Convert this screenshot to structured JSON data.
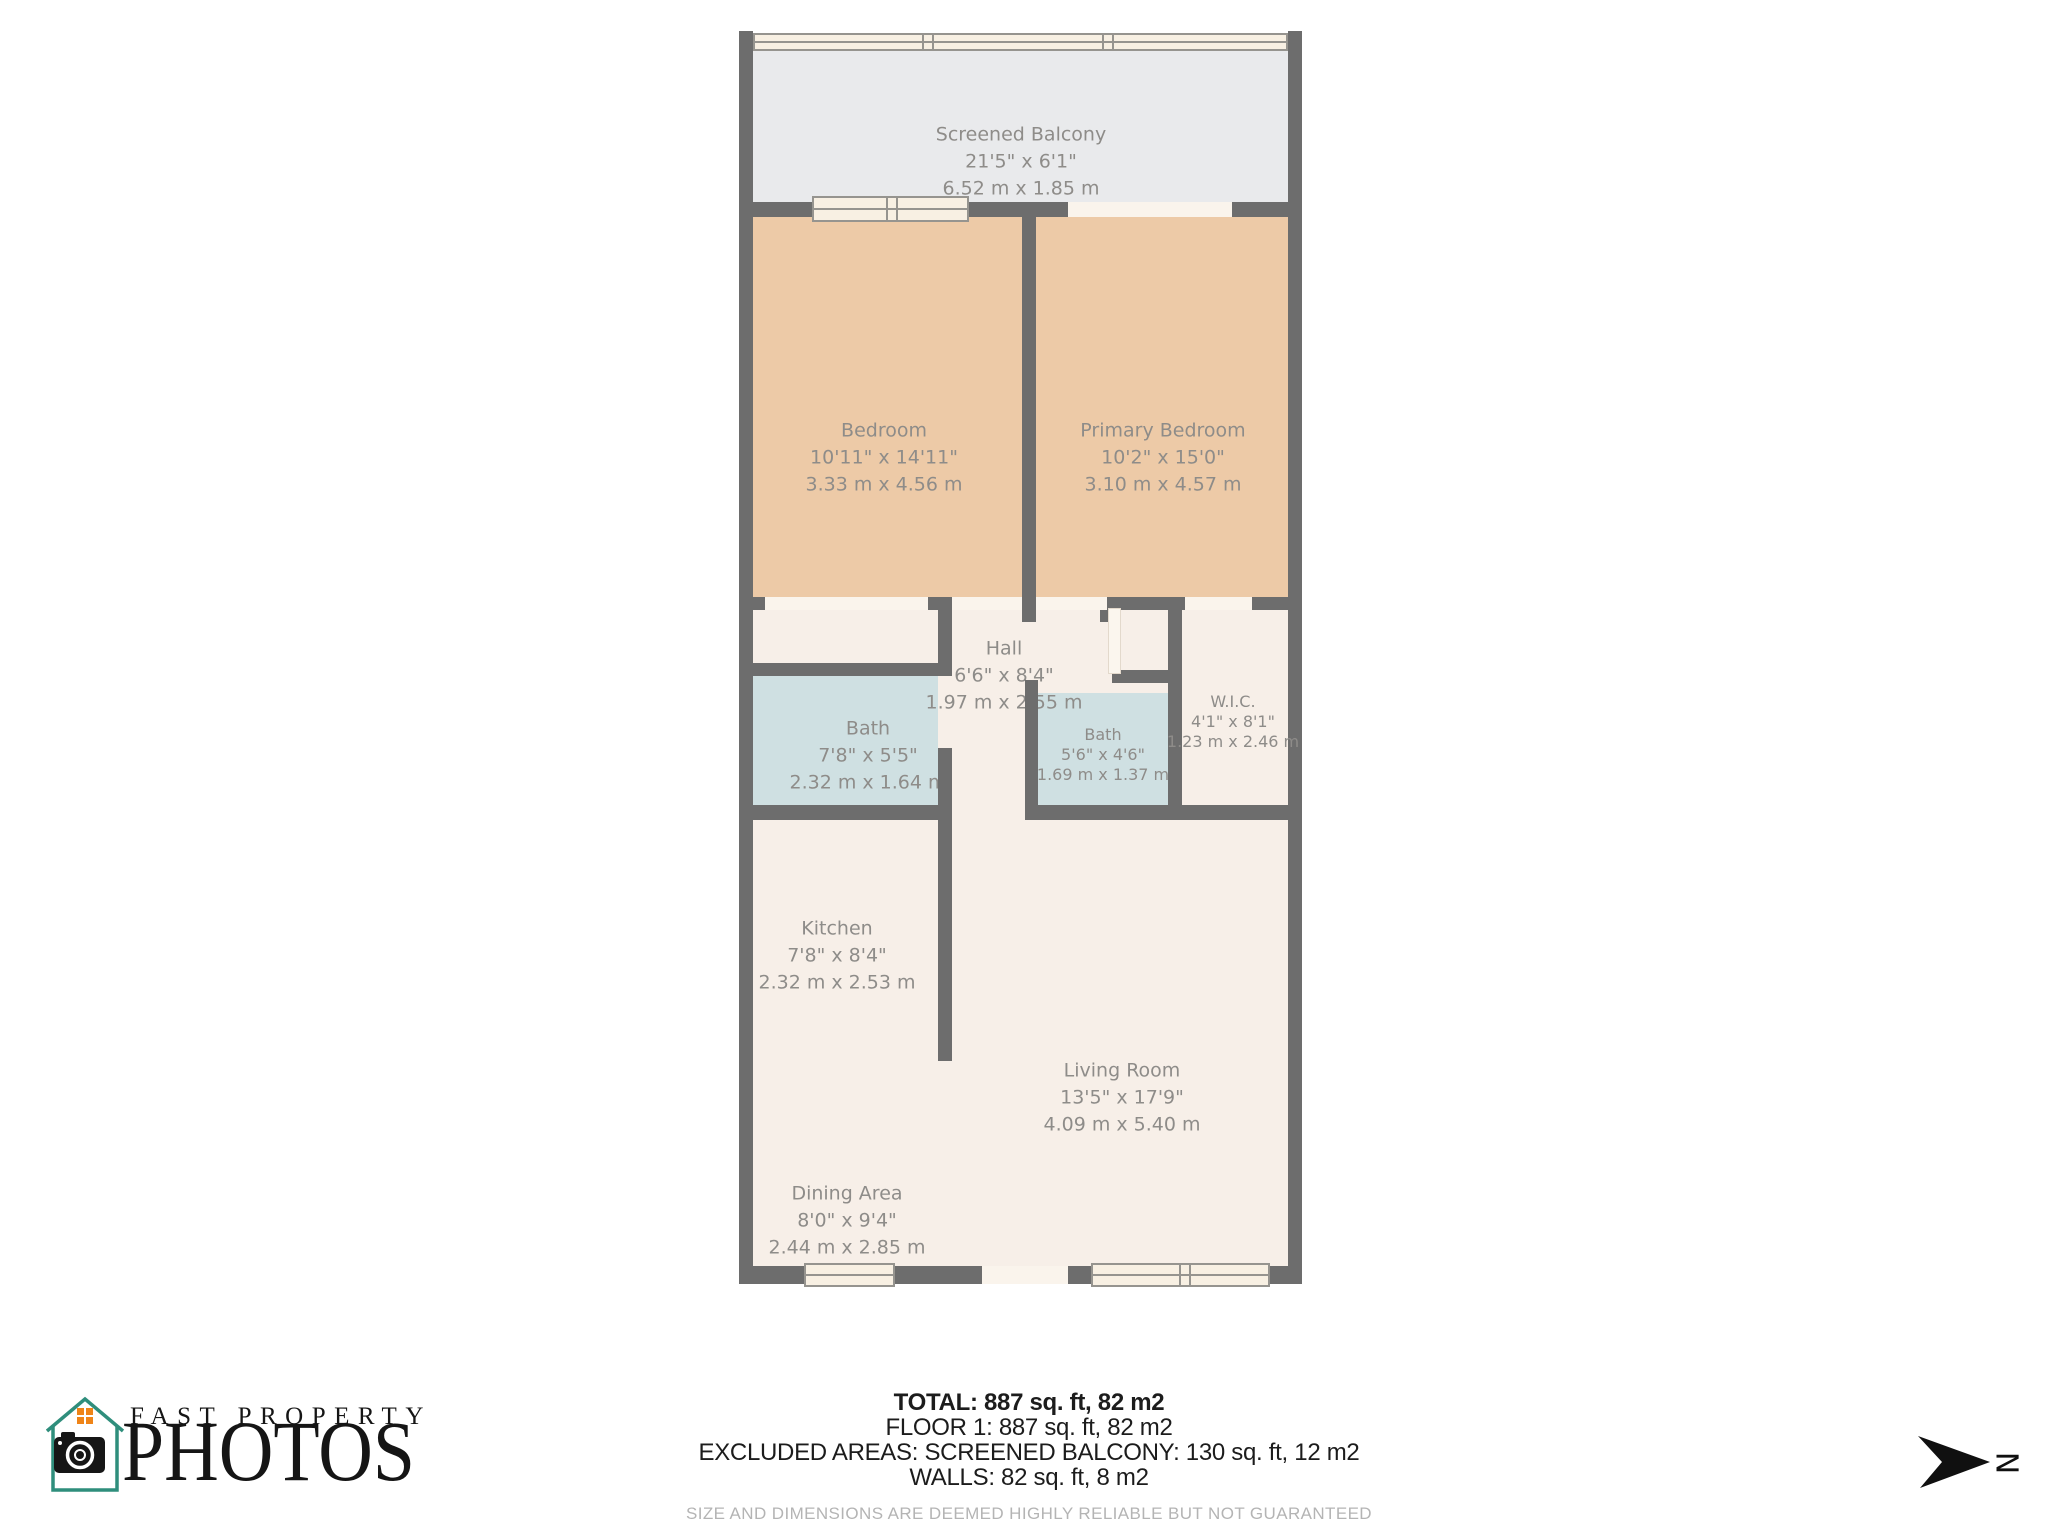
{
  "floorplan": {
    "rooms": [
      {
        "id": "screened-balcony",
        "name": "Screened Balcony",
        "imperial": "21'5\" x 6'1\"",
        "metric": "6.52 m x 1.85 m"
      },
      {
        "id": "bedroom",
        "name": "Bedroom",
        "imperial": "10'11\" x 14'11\"",
        "metric": "3.33 m x 4.56 m"
      },
      {
        "id": "primary-bedroom",
        "name": "Primary Bedroom",
        "imperial": "10'2\" x 15'0\"",
        "metric": "3.10 m x 4.57 m"
      },
      {
        "id": "hall",
        "name": "Hall",
        "imperial": "6'6\" x 8'4\"",
        "metric": "1.97 m x 2.55 m"
      },
      {
        "id": "bath-1",
        "name": "Bath",
        "imperial": "7'8\" x 5'5\"",
        "metric": "2.32 m x 1.64 m"
      },
      {
        "id": "bath-2",
        "name": "Bath",
        "imperial": "5'6\" x 4'6\"",
        "metric": "1.69 m x 1.37 m"
      },
      {
        "id": "wic",
        "name": "W.I.C.",
        "imperial": "4'1\" x 8'1\"",
        "metric": "1.23 m x 2.46 m"
      },
      {
        "id": "kitchen",
        "name": "Kitchen",
        "imperial": "7'8\" x 8'4\"",
        "metric": "2.32 m x 2.53 m"
      },
      {
        "id": "living-room",
        "name": "Living Room",
        "imperial": "13'5\" x 17'9\"",
        "metric": "4.09 m x 5.40 m"
      },
      {
        "id": "dining-area",
        "name": "Dining Area",
        "imperial": "8'0\" x 9'4\"",
        "metric": "2.44 m x 2.85 m"
      }
    ],
    "north_label": "N",
    "colors": {
      "wall": "#6d6d6d",
      "floor": "#f7efe8",
      "bedroom_floor": "#edcaa7",
      "bath_floor": "#cfe0e2",
      "balcony_floor": "#e9eaec",
      "window_fill": "#f8f0e3",
      "window_frame": "#96948f",
      "threshold": "#faf4ec",
      "label_text": "#8e8c89",
      "logo_teal": "#2f8e7c",
      "logo_orange": "#ef8418"
    }
  },
  "summary": {
    "total": "TOTAL: 887 sq. ft, 82 m2",
    "floor1": "FLOOR 1: 887 sq. ft, 82 m2",
    "excluded": "EXCLUDED AREAS: SCREENED BALCONY: 130 sq. ft, 12 m2",
    "walls": "WALLS: 82 sq. ft, 8 m2",
    "disclaimer": "SIZE AND DIMENSIONS ARE DEEMED HIGHLY RELIABLE BUT NOT GUARANTEED"
  },
  "branding": {
    "line1": "FAST PROPERTY",
    "line2": "PHOTOS"
  }
}
